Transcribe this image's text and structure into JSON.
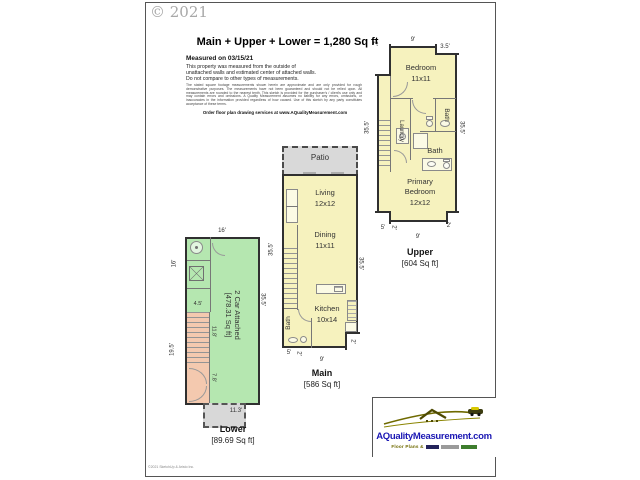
{
  "page": {
    "copyright": "© 2021",
    "title": "Main + Upper + Lower = 1,280 Sq ft",
    "measured_heading": "Measured on 03/15/21",
    "measured_line1": "This property was measured from the outside of",
    "measured_line2": "unattached walls and estimated center of attached walls.",
    "measured_line3": "Do not compare to other types of measurements.",
    "fine_print": "The stated square footage measurements shown herein are approximate and are only provided for rough demonstrative purposes. The measurements have not been guaranteed and should not be relied upon. All measurements are rounded to the nearest tenth. This sketch is provided for the purchaser's / client's use only and may contain errors and omissions. A Quality Measurement assumes no liability for any errors, omissions, or inaccuracies in the information provided regardless of how caused. Use of this sketch by any party constitutes acceptance of these terms.",
    "order_line": "Order floor plan drawing services at www.AQualityMeasurement.com",
    "footer_note": "©2021 SketchUp & Aristo Inc."
  },
  "upper_plan": {
    "title": "Upper",
    "area": "[604 Sq ft]",
    "bedroom_label": "Bedroom",
    "bedroom_size": "11x11",
    "laundry_label": "Laundry",
    "bath_small_label": "Bath",
    "bath_label": "Bath",
    "primary_label": "Primary Bedroom",
    "primary_size": "12x12",
    "dim_top_left": "2'",
    "dim_top": "9'",
    "dim_top_right": "3.5'",
    "dim_left": "35.5'",
    "dim_right": "35.5'",
    "dim_bottom_left_a": "5'",
    "dim_bottom_left_b": "2'",
    "dim_bottom_right": "2'",
    "dim_bottom": "9'"
  },
  "main_plan": {
    "title": "Main",
    "area": "[586 Sq ft]",
    "patio_label": "Patio",
    "living_label": "Living",
    "living_size": "12x12",
    "dining_label": "Dining",
    "dining_size": "11x11",
    "kitchen_label": "Kitchen",
    "kitchen_size": "10x14",
    "bath_label": "Bath",
    "dim_left": "35.5'",
    "dim_right": "35.5'",
    "dim_bottom_left_a": "5'",
    "dim_bottom_left_b": "2'",
    "dim_bottom_right": "2'",
    "dim_bottom": "9'"
  },
  "lower_plan": {
    "title": "Lower",
    "area": "[89.69 Sq ft]",
    "garage_label": "2 Car Attached",
    "garage_area": "[478.31 Sq ft]",
    "dim_top": "16'",
    "dim_left_upper": "16'",
    "dim_left_lower": "19.5'",
    "dim_inner_a": "4.5'",
    "dim_inner_b": "11.8'",
    "dim_inner_c": "7.8'",
    "dim_bottom": "11.3'",
    "dim_right": "35.5'"
  },
  "logo": {
    "site": "AQualityMeasurement.com",
    "tagline": "Floor Plans &",
    "brand_blue": "#1b18b4",
    "olive": "#6f6a00",
    "green": "#3e7d2e"
  }
}
